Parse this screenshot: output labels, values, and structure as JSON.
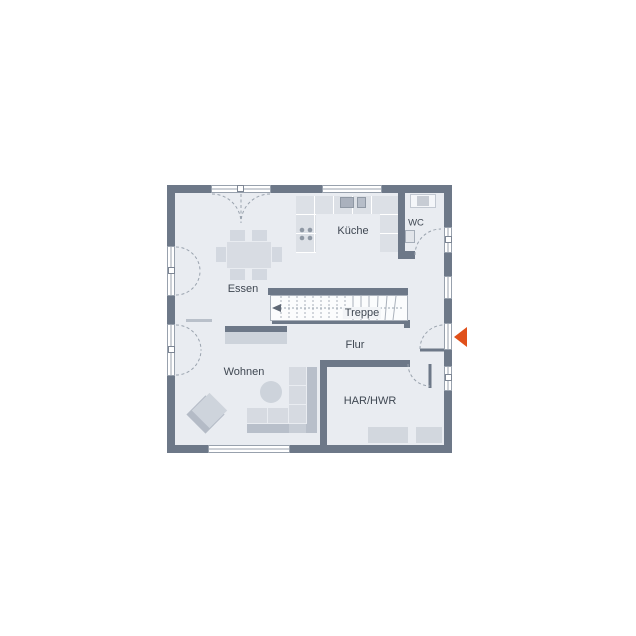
{
  "colors": {
    "wall": "#6d7888",
    "floor": "#e9ecf1",
    "accent": "#e0501a",
    "line": "#98a1ad",
    "label": "#3f4752",
    "furn": "#d3d8e0",
    "furn-dark": "#b8bfca",
    "counter": "#dce0e6"
  },
  "rooms": {
    "kitchen": {
      "label": "Küche"
    },
    "wc": {
      "label": "WC"
    },
    "dining": {
      "label": "Essen"
    },
    "stairs": {
      "label": "Treppe"
    },
    "hall": {
      "label": "Flur"
    },
    "living": {
      "label": "Wohnen"
    },
    "utility": {
      "label": "HAR/HWR"
    }
  }
}
